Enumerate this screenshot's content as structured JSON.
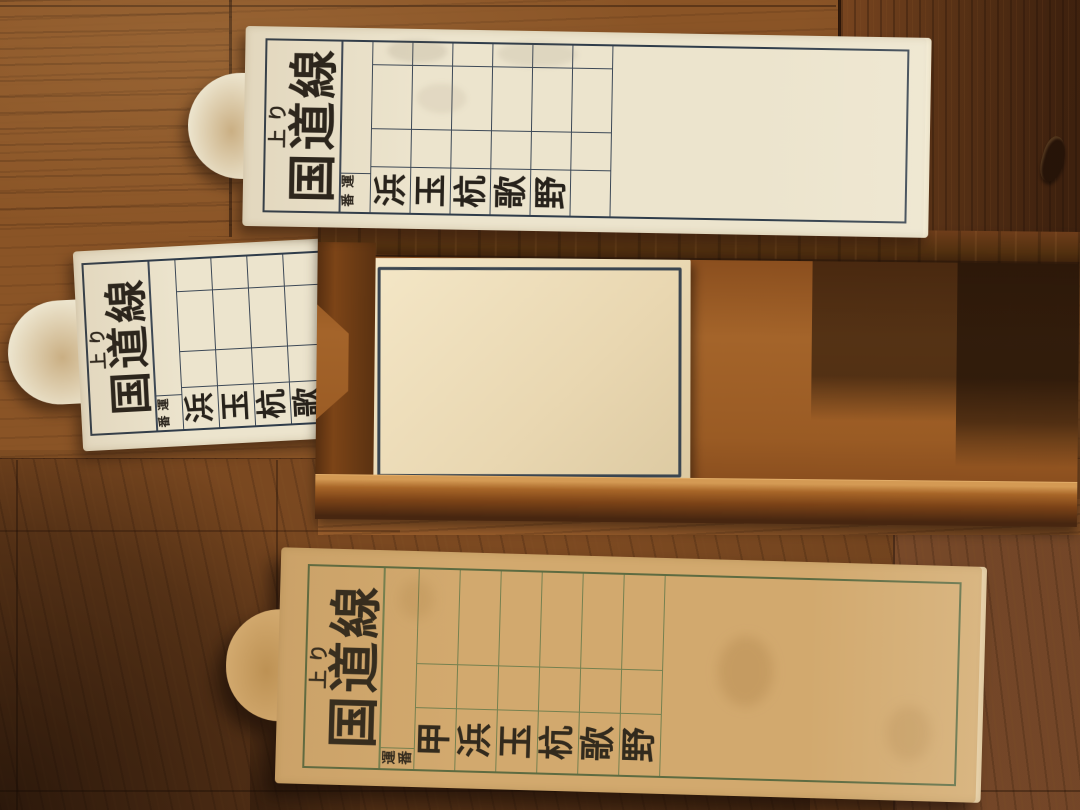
{
  "scene": {
    "description": "Three vintage Japanese destination plates for the Kokudo Line on a wooden floor; a blank plate sits in a brown wooden holder rack",
    "colors": {
      "floor_brown": "#8a5426",
      "holder_brown": "#9a5b24",
      "rail_dark_brown": "#4f2a10",
      "paper_cream": "#ece4cd",
      "paper_tan": "#d2a96e",
      "frame_navy": "#2f3c4a",
      "frame_green": "#5d6b42",
      "ink": "#27221b"
    }
  },
  "cards": {
    "top": {
      "direction": "上り",
      "line_name": "国道線",
      "duty_label": "運番",
      "stations": [
        "浜",
        "玉",
        "杭",
        "歌",
        "野"
      ]
    },
    "middle": {
      "direction": "上り",
      "line_name": "国道線",
      "duty_label": "運番",
      "stations": [
        "浜",
        "玉",
        "杭",
        "歌",
        "野"
      ]
    },
    "bottom": {
      "direction": "上り",
      "line_name": "国道線",
      "duty_label": "運番",
      "stations": [
        "甲",
        "浜",
        "玉",
        "杭",
        "歌",
        "野"
      ]
    }
  }
}
